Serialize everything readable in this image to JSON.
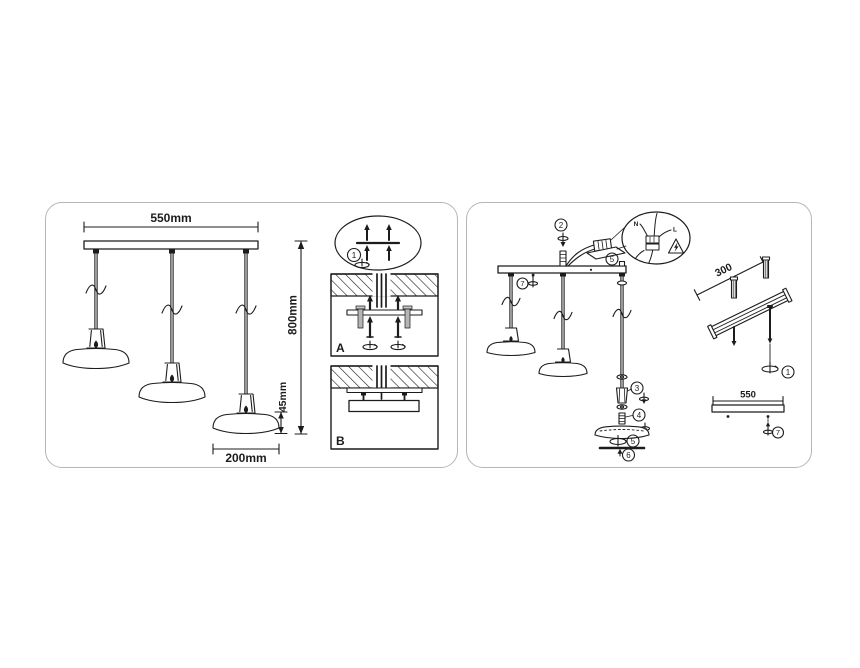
{
  "left_panel": {
    "dim_bar_width": "550mm",
    "dim_drop_height": "800mm",
    "dim_shade_height": "45mm",
    "dim_shade_diameter": "200mm",
    "detail_callout": "1",
    "step_a": "A",
    "step_b": "B"
  },
  "right_panel": {
    "callout_hanger_screw": "2",
    "callout_terminal_block": "5",
    "callout_canopy_screw": "7",
    "callout_cord_grip": "3",
    "callout_threaded_nipple": "4",
    "callout_shade": "5",
    "callout_diffuser": "6",
    "callout_mounting_screw": "1",
    "callout_bar_screw": "7",
    "dim_rail_spacing": "300",
    "dim_bar_length": "550",
    "wire_neutral": "N",
    "wire_live": "L",
    "warning_icon": "electric-shock-warning-triangle"
  },
  "colors": {
    "line": "#1c1c1c",
    "panel_border": "#b6b6b6",
    "background": "#ffffff",
    "anchor_gray": "#b5b5b5"
  }
}
